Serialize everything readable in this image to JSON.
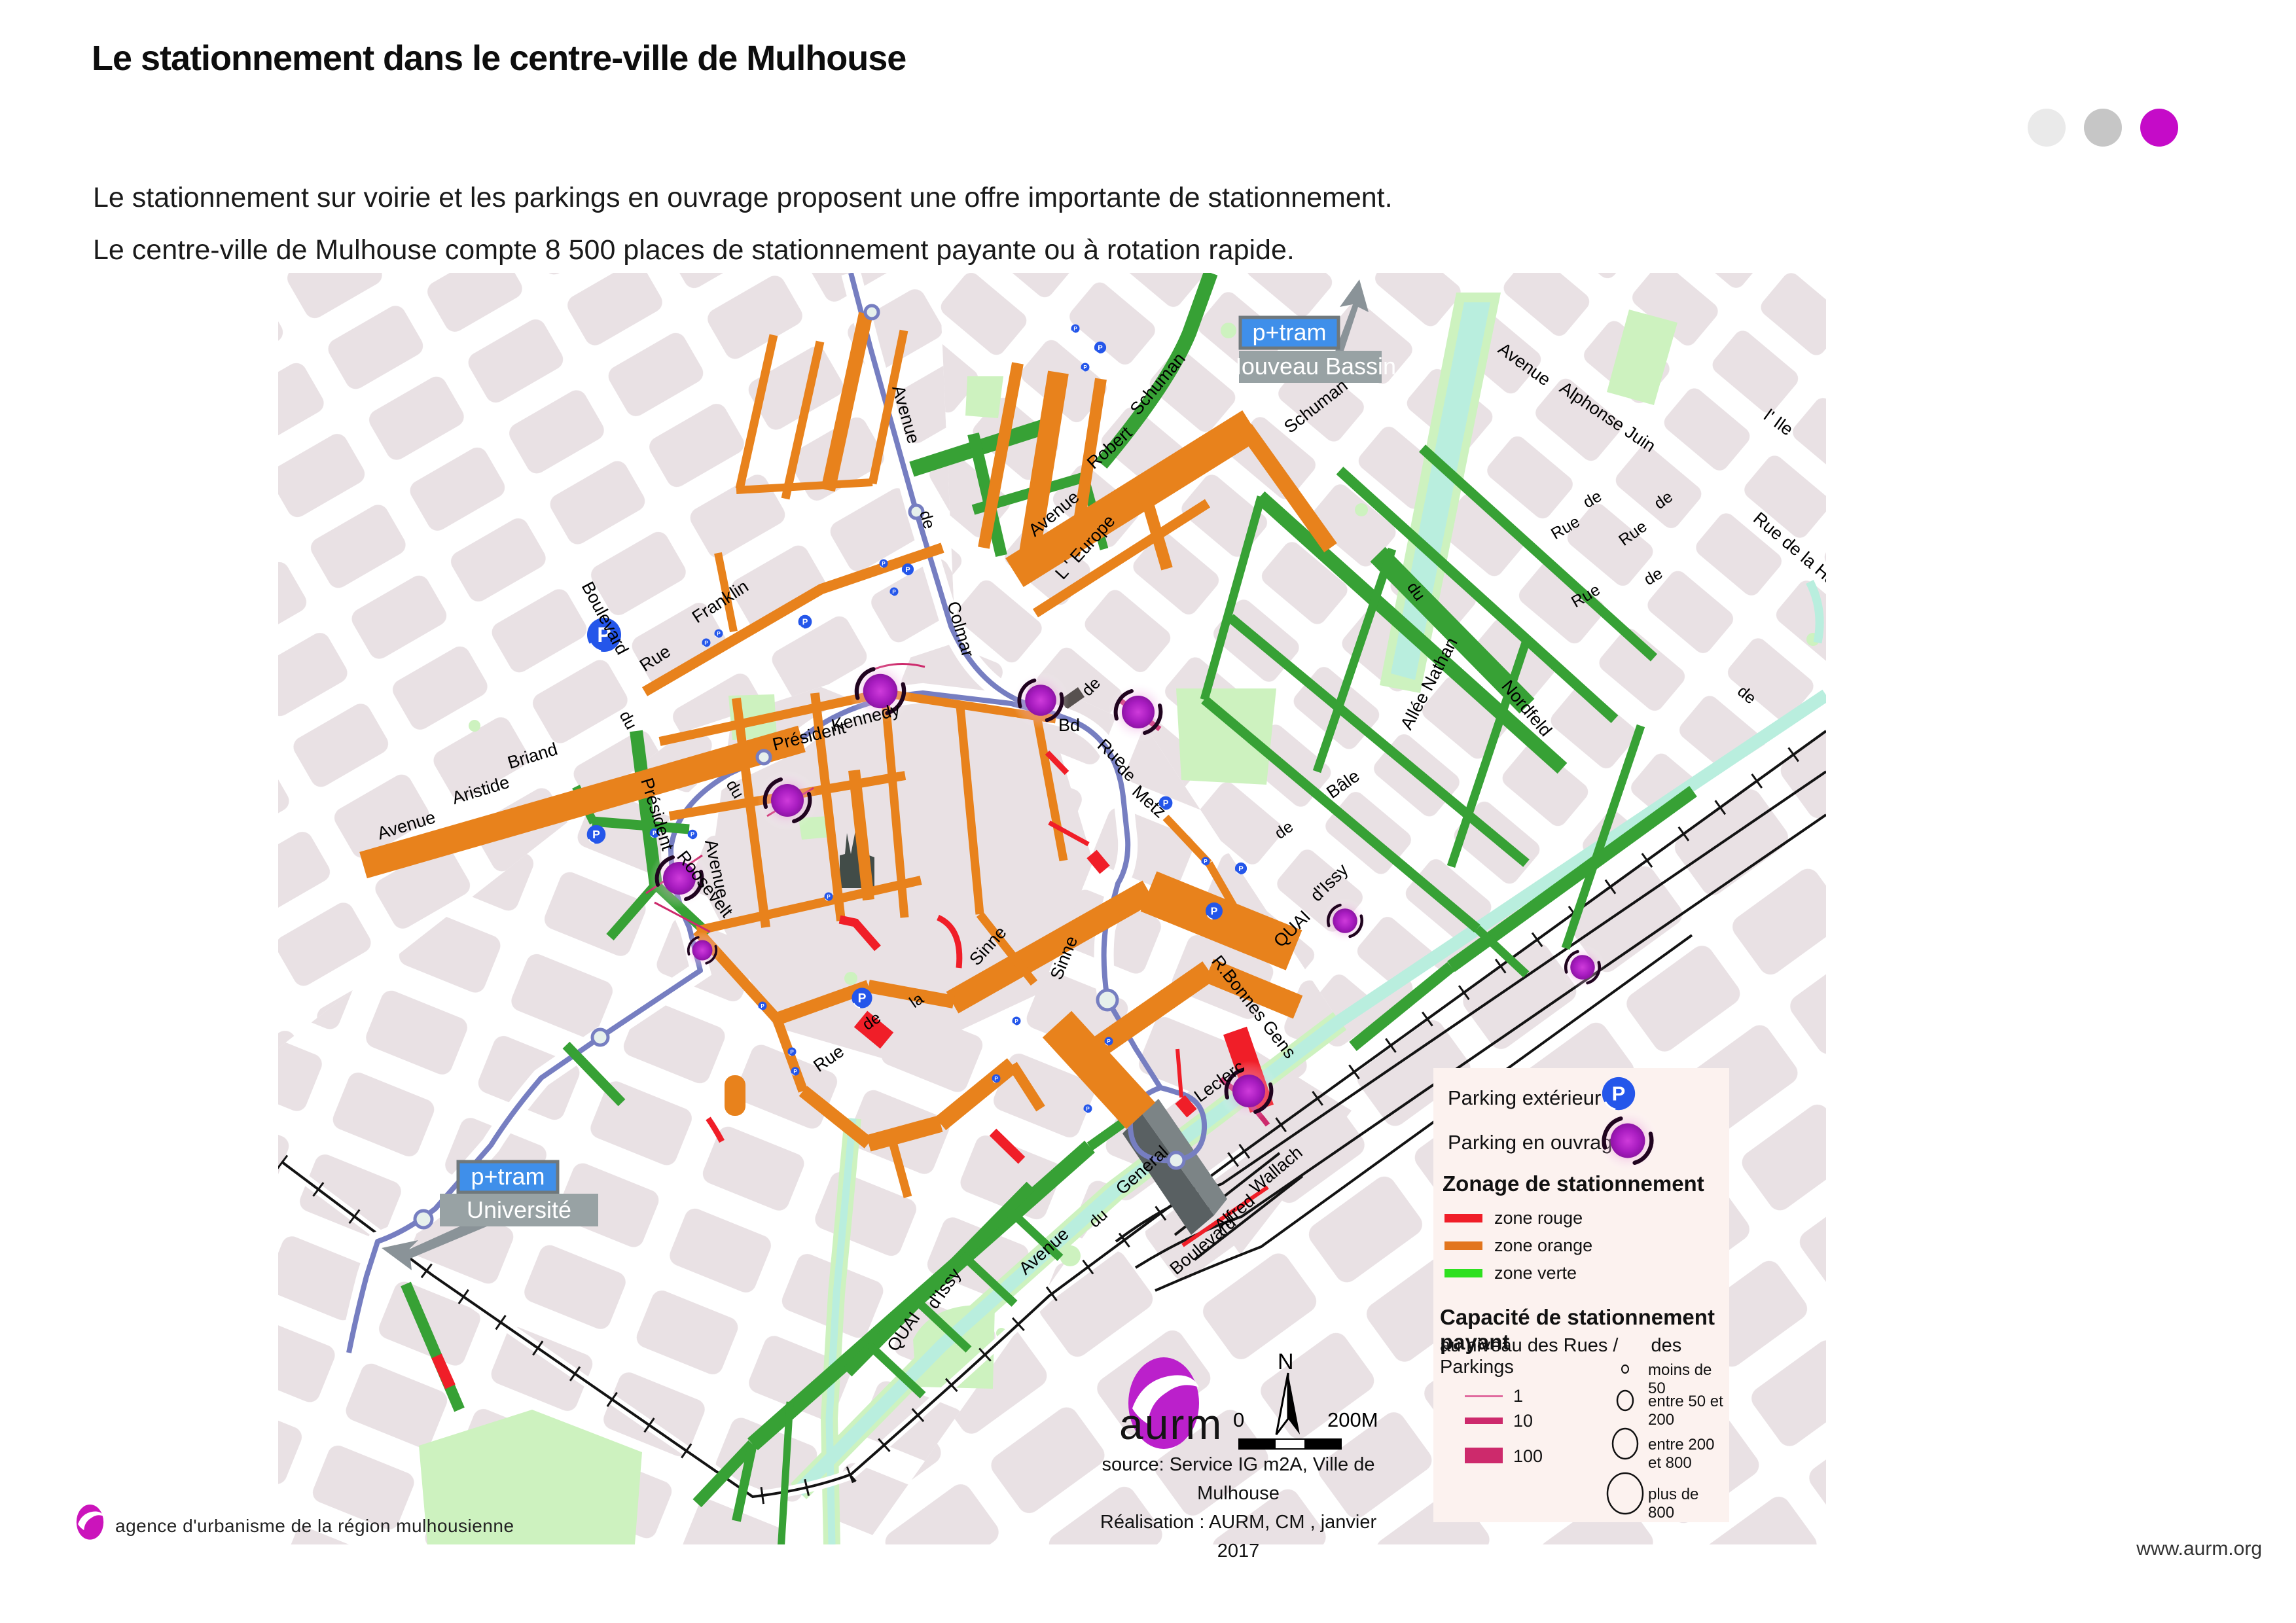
{
  "header": {
    "title": "Le stationnement dans le centre-ville de Mulhouse",
    "subtitle_line1": "Le stationnement sur voirie et les parkings en ouvrage proposent une offre importante de stationnement.",
    "subtitle_line2": "Le centre-ville de Mulhouse compte 8 500 places de stationnement payante ou à rotation rapide.",
    "dot_colors": [
      "#eaeaea",
      "#c6c6c6",
      "#c50bc8"
    ]
  },
  "map": {
    "p_letter": "P",
    "ptram_top": {
      "badge": "p+tram",
      "station": "Nouveau Bassin"
    },
    "ptram_bottom": {
      "badge": "p+tram",
      "station": "Université"
    },
    "street_labels": [
      "Boulevard",
      "du",
      "Rue",
      "Franklin",
      "Avenue",
      "de",
      "Colmar",
      "Avenue",
      "Aristide",
      "Briand",
      "Président",
      "Kennedy",
      "Président",
      "Roosevelt",
      "Avenue",
      "du",
      "Avenue",
      "L ' Europe",
      "Robert",
      "Schuman",
      "Schuman",
      "Allée  Nathan",
      "Avenue",
      "Alphonse Juin",
      "l' Ile",
      "Rue",
      "de",
      "Rue",
      "de",
      "du",
      "Nordfeld",
      "Rue",
      "de",
      "Rue de la Hardt",
      "de",
      "de",
      "Bâle",
      "Bd",
      "de",
      "Rue",
      "de",
      "Metz",
      "R.Bonnes Gens",
      "QUAI",
      "d'Issy",
      "Rue",
      "de",
      "la",
      "Sinne",
      "Sinne",
      "Avenue",
      "du",
      "General",
      "Leclerc",
      "Boulevard",
      "Alfred",
      "Wallach",
      "QUAI",
      "d'Issy"
    ]
  },
  "legend": {
    "parking_exterieur_label": "Parking extérieur",
    "parking_ouvrage_label": "Parking en ouvrage",
    "zonage_title": "Zonage de stationnement",
    "zones": [
      {
        "label": "zone rouge",
        "color": "#f01e28"
      },
      {
        "label": "zone orange",
        "color": "#e2751d"
      },
      {
        "label": "zone verte",
        "color": "#2ee01f"
      }
    ],
    "capacity_title": "Capacité de stationnement payant",
    "capacity_sub_left": "au niveau des Rues /",
    "capacity_sub_right": "des Parkings",
    "street_capacity": [
      {
        "label": "1"
      },
      {
        "label": "10"
      },
      {
        "label": "100"
      }
    ],
    "parking_capacity": [
      {
        "label": "moins de 50"
      },
      {
        "label": "entre 50 et 200"
      },
      {
        "label": "entre 200 et 800"
      },
      {
        "label": "plus de 800"
      }
    ],
    "capacity_color": "#cd2a6c"
  },
  "scalebar": {
    "zero": "0",
    "north": "N",
    "distance": "200M"
  },
  "credits": {
    "logo_text": "aurm",
    "source_line1": "source: Service IG m2A, Ville de Mulhouse",
    "source_line2": "Réalisation : AURM, CM , janvier 2017"
  },
  "footer": {
    "agency": "agence d'urbanisme de la région mulhousienne",
    "website": "www.aurm.org"
  },
  "colors": {
    "zone_orange_map": "#e8821c",
    "zone_verte_map": "#37a135",
    "zone_rouge": "#f01e28",
    "parking_exterieur": "#2456ea",
    "parking_ouvrage": "#a81cc0",
    "tram": "#767ec1",
    "water": "#b9eede",
    "park": "#cdf2bf",
    "building": "#e9e1e4"
  }
}
